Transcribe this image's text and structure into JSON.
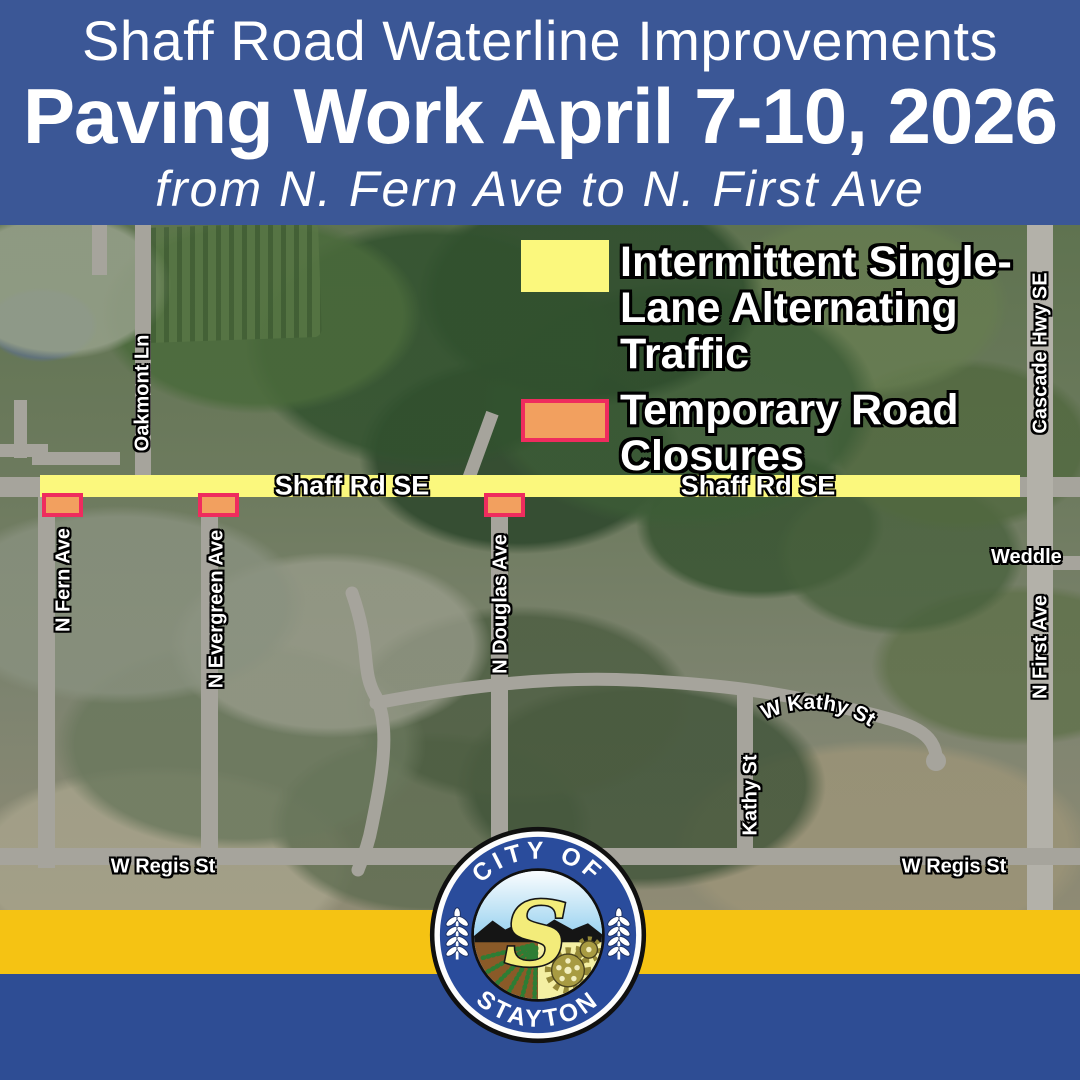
{
  "header": {
    "title": "Shaff Road Waterline Improvements",
    "subtitle": "Paving Work April 7-10, 2026",
    "range": "from N. Fern Ave to N. First Ave"
  },
  "legend": {
    "items": [
      {
        "id": "single-lane",
        "swatch_color": "#FBF87D",
        "label": "Intermittent Single-Lane Alternating Traffic"
      },
      {
        "id": "closures",
        "swatch_color": "#F2A05F",
        "swatch_border": "#EF2C5E",
        "label": "Temporary Road Closures"
      }
    ]
  },
  "map": {
    "road_highlight": {
      "label_west": "Shaff Rd SE",
      "label_east": "Shaff Rd SE",
      "color": "#FBF87D"
    },
    "closures": [
      {
        "at": "N Fern Ave"
      },
      {
        "at": "N Evergreen Ave"
      },
      {
        "at": "N Douglas Ave"
      }
    ],
    "street_labels": {
      "oakmont": "Oakmont Ln",
      "cascade_hwy": "Cascade Hwy SE",
      "n_fern": "N Fern Ave",
      "n_evergreen": "N Evergreen Ave",
      "n_douglas": "N Douglas Ave",
      "weddle": "Weddle",
      "n_first": "N First Ave",
      "w_kathy": "W Kathy St",
      "kathy": "Kathy St",
      "w_regis_west": "W Regis St",
      "w_regis_east": "W Regis St"
    }
  },
  "footer": {
    "band_gold": "#F5C313",
    "band_blue": "#2E4D94"
  },
  "logo": {
    "top_text": "CITY OF",
    "bottom_text": "STAYTON",
    "monogram": "S"
  },
  "colors": {
    "header_background": "#3B5796",
    "highlight_yellow": "#FBF87D",
    "closure_orange": "#F2A05F",
    "closure_border_pink": "#EF2C5E",
    "map_road_gray": "#A6A49C"
  }
}
